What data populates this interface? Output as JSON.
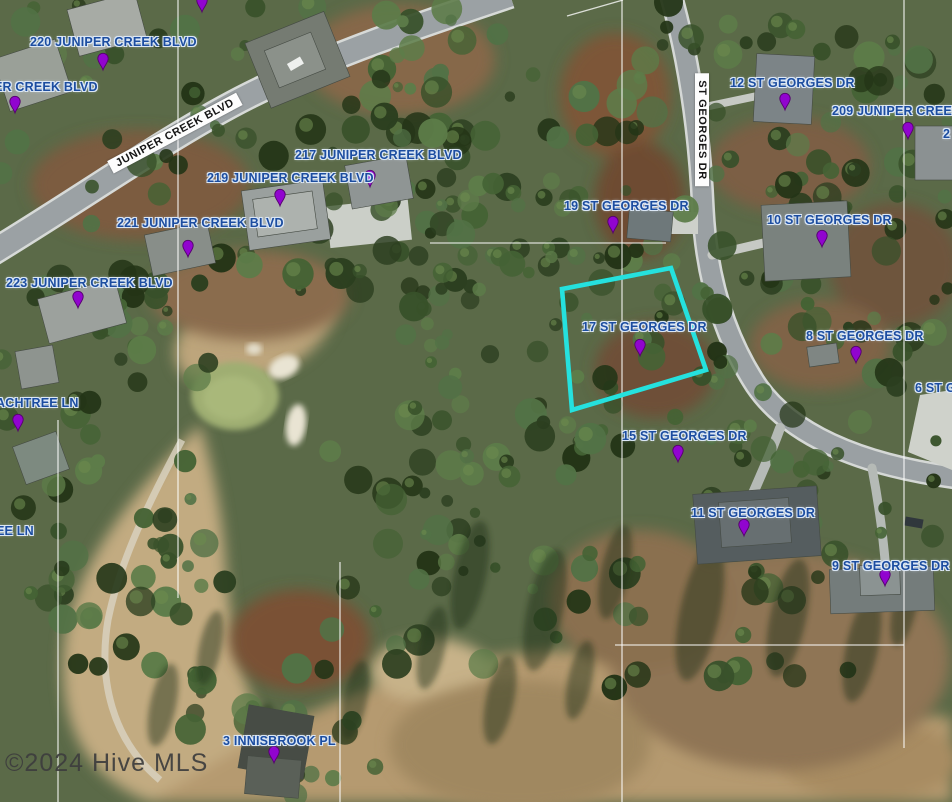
{
  "map": {
    "provider_watermark": "©2024 Hive MLS",
    "colors": {
      "label": "#1c4da0",
      "label_halo": "#dbe7f6",
      "marker": "#9104cf",
      "marker_outline": "#55026e",
      "parcel_outline": "#25e1de",
      "street_strip_bg": "#fdfdfd",
      "street_strip_text": "#151515",
      "watermark": "#3e3e3e"
    },
    "selected_parcel": {
      "label": "17 ST GEORGES DR",
      "outline_points": [
        [
          562,
          289
        ],
        [
          671,
          268
        ],
        [
          706,
          370
        ],
        [
          572,
          410
        ]
      ]
    },
    "street_name_strips": [
      {
        "text": "JUNIPER CREEK BLVD",
        "x": 175,
        "y": 133,
        "rotate": -28
      },
      {
        "text": "ST GEORGES DR",
        "x": 702,
        "y": 130,
        "rotate": 90
      }
    ],
    "address_labels": [
      {
        "text": "220 JUNIPER CREEK BLVD",
        "x": 30,
        "y": 35
      },
      {
        "text": "ER CREEK BLVD",
        "x": -6,
        "y": 80
      },
      {
        "text": "217 JUNIPER CREEK BLVD",
        "x": 295,
        "y": 148
      },
      {
        "text": "219 JUNIPER CREEK BLVD",
        "x": 207,
        "y": 171
      },
      {
        "text": "221 JUNIPER CREEK BLVD",
        "x": 117,
        "y": 216
      },
      {
        "text": "223 JUNIPER CREEK BLVD",
        "x": 6,
        "y": 276
      },
      {
        "text": "12 ST GEORGES DR",
        "x": 730,
        "y": 76
      },
      {
        "text": "209 JUNIPER CREEK",
        "x": 832,
        "y": 104
      },
      {
        "text": "2",
        "x": 943,
        "y": 127
      },
      {
        "text": "19 ST GEORGES DR",
        "x": 564,
        "y": 199
      },
      {
        "text": "10 ST GEORGES DR",
        "x": 767,
        "y": 213
      },
      {
        "text": "17 ST GEORGES DR",
        "x": 582,
        "y": 320
      },
      {
        "text": "8 ST GEORGES DR",
        "x": 806,
        "y": 329
      },
      {
        "text": "6 ST G",
        "x": 915,
        "y": 381
      },
      {
        "text": "15 ST GEORGES DR",
        "x": 622,
        "y": 429
      },
      {
        "text": "11 ST GEORGES DR",
        "x": 691,
        "y": 506
      },
      {
        "text": "9 ST GEORGES DR",
        "x": 832,
        "y": 559
      },
      {
        "text": "ACHTREE LN",
        "x": -4,
        "y": 396
      },
      {
        "text": "EE LN",
        "x": -4,
        "y": 524
      },
      {
        "text": "3 INNISBROOK PL",
        "x": 223,
        "y": 734
      }
    ],
    "markers": [
      [
        103,
        70
      ],
      [
        15,
        113
      ],
      [
        202,
        12
      ],
      [
        370,
        187
      ],
      [
        280,
        206
      ],
      [
        188,
        257
      ],
      [
        78,
        308
      ],
      [
        785,
        110
      ],
      [
        908,
        139
      ],
      [
        613,
        233
      ],
      [
        822,
        247
      ],
      [
        640,
        356
      ],
      [
        856,
        363
      ],
      [
        678,
        462
      ],
      [
        744,
        536
      ],
      [
        885,
        586
      ],
      [
        274,
        763
      ],
      [
        18,
        431
      ]
    ]
  }
}
